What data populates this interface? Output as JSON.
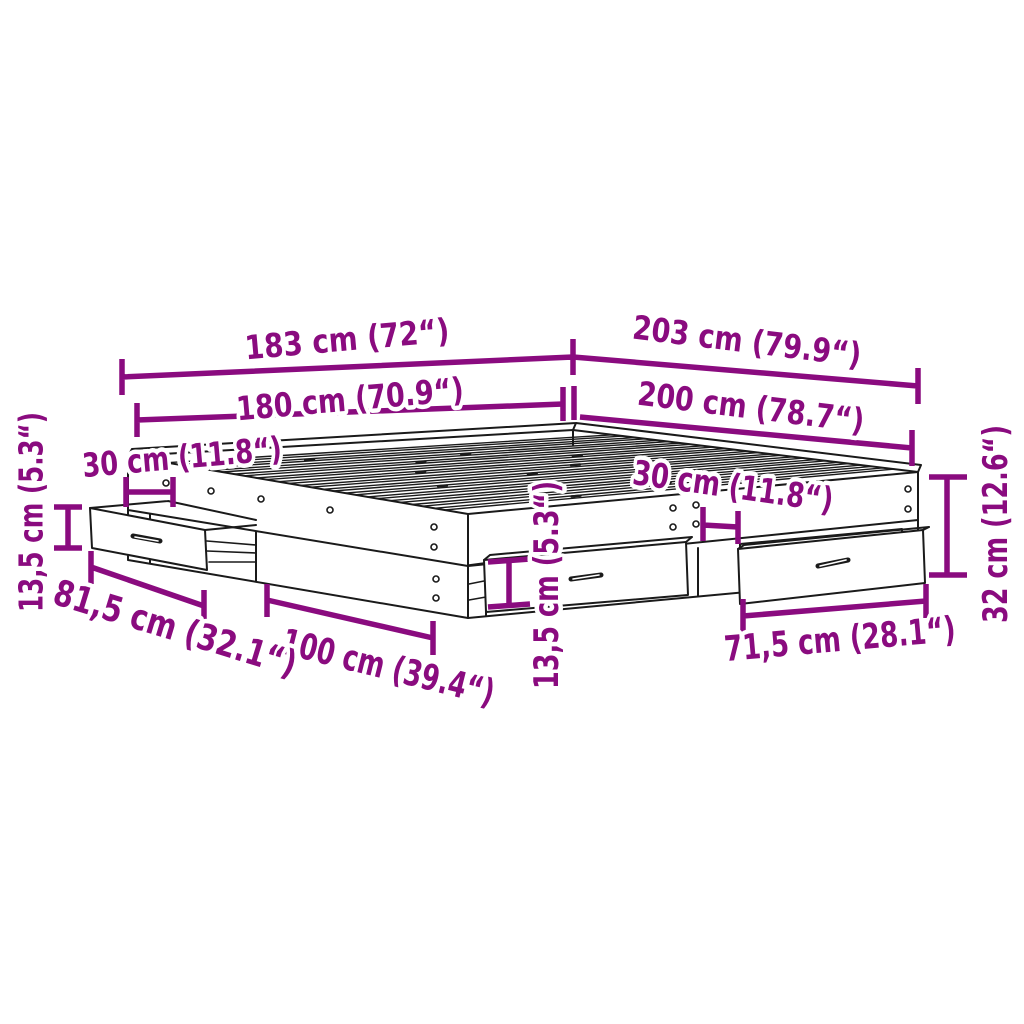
{
  "diagram": {
    "type": "furniture-dimension-diagram",
    "subject": "bed-frame-with-storage-drawers",
    "colors": {
      "dimension": "#8A0B7F",
      "line_art": "#1A1A1A",
      "background": "#FFFFFF"
    },
    "labels": {
      "top_width_outer": "183 cm (72“)",
      "top_length_outer": "203 cm (79.9“)",
      "top_width_inner": "180 cm (70.9“)",
      "top_length_inner": "200 cm (78.7“)",
      "left_offset": "30 cm (11.8“)",
      "right_offset": "30 cm (11.8“)",
      "left_drawer_height": "13,5 cm (5.3“)",
      "middle_drawer_height": "13,5 cm (5.3“)",
      "frame_height": "32 cm (12.6“)",
      "left_drawer_width": "81,5 cm (32.1“)",
      "middle_drawer_width": "100 cm (39.4“)",
      "right_drawer_width": "71,5 cm (28.1“)"
    }
  }
}
